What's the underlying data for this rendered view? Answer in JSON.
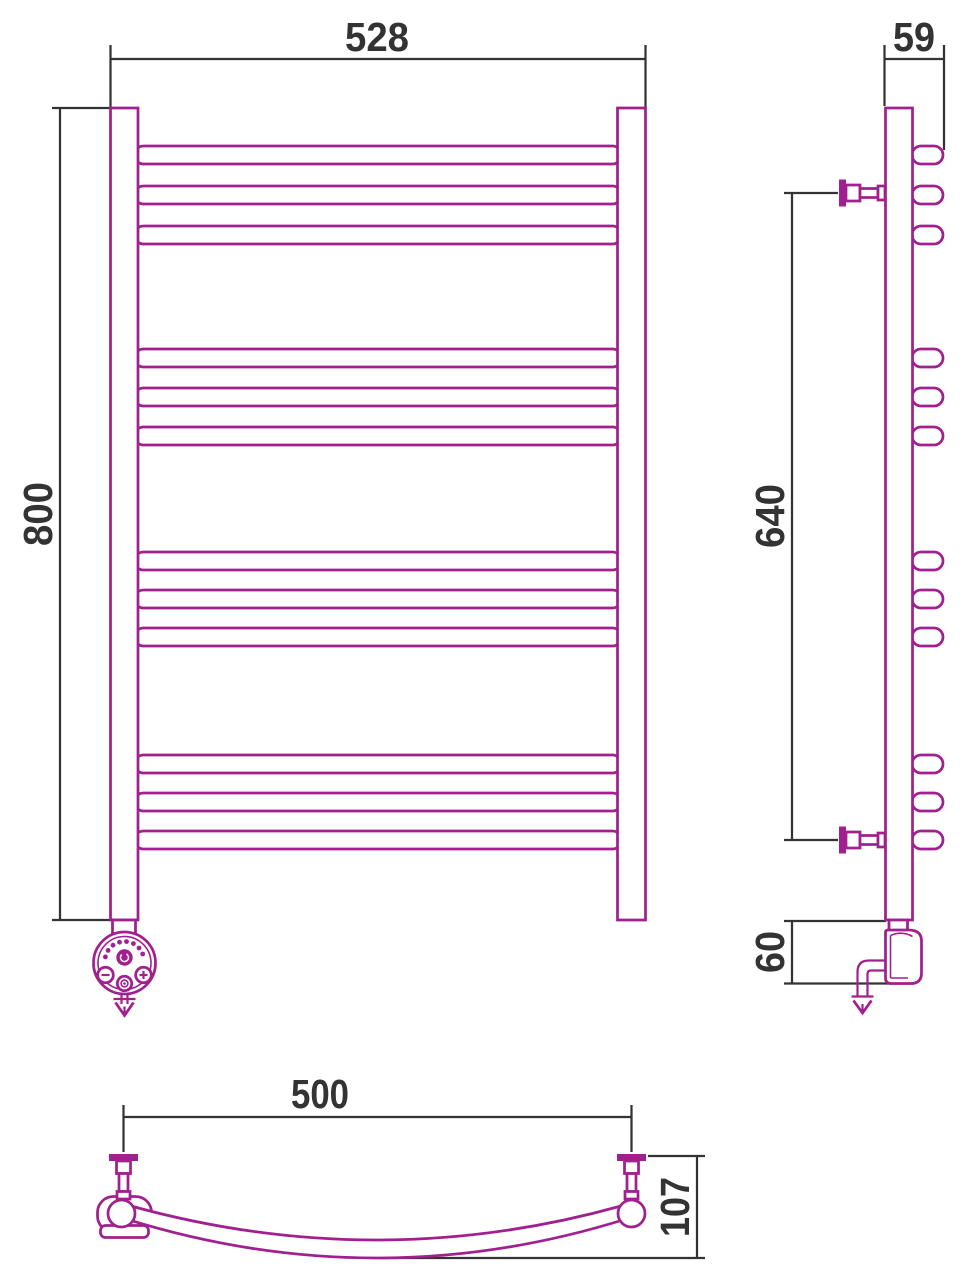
{
  "theme": {
    "accent": "#A1208F",
    "dim": "#333333",
    "bg": "#FFFFFF"
  },
  "dims": {
    "front_width": "528",
    "front_height": "800",
    "side_depth": "59",
    "side_span": "640",
    "side_heater": "60",
    "bottom_span": "500",
    "bottom_bow": "107"
  }
}
